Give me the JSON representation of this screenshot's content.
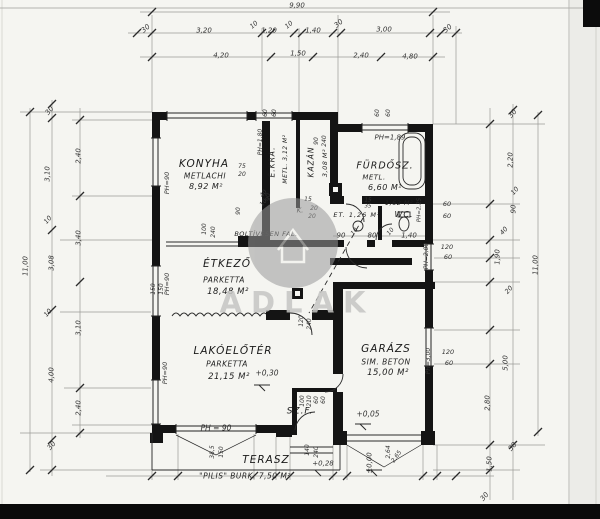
{
  "watermark": {
    "t": "ADLAK",
    "x": 297,
    "y": 303,
    "s": 29
  },
  "rooms": [
    {
      "id": "konyha",
      "label": {
        "t": "KONYHA",
        "x": 204,
        "y": 164,
        "s": 10.5
      },
      "material": {
        "t": "METLACHI",
        "x": 205,
        "y": 176,
        "s": 7.5
      },
      "area": {
        "t": "8,92 M²",
        "x": 206,
        "y": 187,
        "s": 8
      }
    },
    {
      "id": "eleskamra",
      "label": {
        "t": "É.KRA.",
        "x": 272,
        "y": 162,
        "s": 7.5,
        "r": -90
      },
      "material": {
        "t": "METL. 3,12 M²",
        "x": 286,
        "y": 159,
        "s": 6,
        "r": -90
      }
    },
    {
      "id": "kazan",
      "label": {
        "t": "KAZÁN",
        "x": 311,
        "y": 162,
        "s": 7.5,
        "r": -90
      },
      "area": {
        "t": "3,08 M²",
        "x": 325,
        "y": 163,
        "s": 6.5,
        "r": -90
      }
    },
    {
      "id": "furdoszoba",
      "label": {
        "t": "FÜRDŐSZ.",
        "x": 385,
        "y": 166,
        "s": 9.5
      },
      "material": {
        "t": "METL.",
        "x": 374,
        "y": 178,
        "s": 7
      },
      "area": {
        "t": "6,60 M²",
        "x": 385,
        "y": 188,
        "s": 8
      }
    },
    {
      "id": "eloter",
      "label": {
        "t": "ET. 1,26 M²",
        "x": 357,
        "y": 215,
        "s": 6.5
      }
    },
    {
      "id": "wc",
      "label": {
        "t": "WC.",
        "x": 404,
        "y": 215,
        "s": 8
      },
      "area": {
        "t": "1,62 M²",
        "x": 399,
        "y": 203,
        "s": 6.5
      }
    },
    {
      "id": "etkezo",
      "label": {
        "t": "ÉTKEZŐ",
        "x": 227,
        "y": 264,
        "s": 10.5
      },
      "material": {
        "t": "PARKETTA",
        "x": 224,
        "y": 280,
        "s": 7.5
      },
      "area": {
        "t": "18,48 M²",
        "x": 228,
        "y": 292,
        "s": 8.5
      }
    },
    {
      "id": "lakoeloter",
      "label": {
        "t": "LAKÓELŐTÉR",
        "x": 233,
        "y": 351,
        "s": 10.5
      },
      "material": {
        "t": "PARKETTA",
        "x": 227,
        "y": 364,
        "s": 7.5
      },
      "area": {
        "t": "21,15 M²",
        "x": 229,
        "y": 377,
        "s": 8.5
      }
    },
    {
      "id": "garazs",
      "label": {
        "t": "GARÁZS",
        "x": 386,
        "y": 349,
        "s": 10.5
      },
      "material": {
        "t": "SIM. BETON",
        "x": 386,
        "y": 362,
        "s": 7.5
      },
      "area": {
        "t": "15,00 M²",
        "x": 388,
        "y": 373,
        "s": 8.5
      }
    },
    {
      "id": "szelfogo",
      "label": {
        "t": "SZ.F.",
        "x": 300,
        "y": 412,
        "s": 9
      }
    },
    {
      "id": "terasz",
      "label": {
        "t": "TERASZ",
        "x": 266,
        "y": 460,
        "s": 10.5
      },
      "material": {
        "t": "\"PILIS\"  BURK.  7,50 M²",
        "x": 245,
        "y": 476,
        "s": 7.5
      }
    }
  ],
  "dimensions": {
    "top": [
      {
        "t": "9,90",
        "x": 297,
        "y": 6,
        "s": 7
      },
      {
        "t": "30",
        "x": 146,
        "y": 29,
        "s": 7,
        "r": -40
      },
      {
        "t": "3,20",
        "x": 204,
        "y": 31,
        "s": 7
      },
      {
        "t": "10",
        "x": 254,
        "y": 25,
        "s": 6.5,
        "r": -40
      },
      {
        "t": "1,20",
        "x": 269,
        "y": 31,
        "s": 7
      },
      {
        "t": "10",
        "x": 289,
        "y": 25,
        "s": 6.5,
        "r": -40
      },
      {
        "t": "1,40",
        "x": 313,
        "y": 31,
        "s": 7
      },
      {
        "t": "30",
        "x": 339,
        "y": 24,
        "s": 7,
        "r": -40
      },
      {
        "t": "3,00",
        "x": 384,
        "y": 30,
        "s": 7
      },
      {
        "t": "30",
        "x": 448,
        "y": 29,
        "s": 7,
        "r": -40
      },
      {
        "t": "4,20",
        "x": 221,
        "y": 56,
        "s": 7
      },
      {
        "t": "1,50",
        "x": 298,
        "y": 54,
        "s": 7
      },
      {
        "t": "2,40",
        "x": 361,
        "y": 56,
        "s": 7
      },
      {
        "t": "4,80",
        "x": 410,
        "y": 57,
        "s": 7
      }
    ],
    "left": [
      {
        "t": "30",
        "x": 50,
        "y": 111,
        "s": 7,
        "r": -50
      },
      {
        "t": "2,40",
        "x": 79,
        "y": 156,
        "s": 7,
        "r": -90
      },
      {
        "t": "3,10",
        "x": 48,
        "y": 174,
        "s": 7,
        "r": -90
      },
      {
        "t": "10",
        "x": 48,
        "y": 220,
        "s": 6.5,
        "r": -50
      },
      {
        "t": "3,40",
        "x": 79,
        "y": 238,
        "s": 7,
        "r": -90
      },
      {
        "t": "3,08",
        "x": 52,
        "y": 263,
        "s": 7,
        "r": -90
      },
      {
        "t": "11,00",
        "x": 26,
        "y": 266,
        "s": 7,
        "r": -90
      },
      {
        "t": "10",
        "x": 48,
        "y": 313,
        "s": 6.5,
        "r": -50
      },
      {
        "t": "3,10",
        "x": 79,
        "y": 328,
        "s": 7,
        "r": -90
      },
      {
        "t": "4,00",
        "x": 52,
        "y": 375,
        "s": 7,
        "r": -90
      },
      {
        "t": "2,40",
        "x": 79,
        "y": 408,
        "s": 7,
        "r": -90
      },
      {
        "t": "30",
        "x": 52,
        "y": 446,
        "s": 7,
        "r": -50
      }
    ],
    "right": [
      {
        "t": "30",
        "x": 513,
        "y": 114,
        "s": 7,
        "r": -50
      },
      {
        "t": "2,20",
        "x": 511,
        "y": 160,
        "s": 7,
        "r": -90
      },
      {
        "t": "10",
        "x": 515,
        "y": 191,
        "s": 6.5,
        "r": -50
      },
      {
        "t": "90",
        "x": 514,
        "y": 209,
        "s": 7,
        "r": -90
      },
      {
        "t": "40",
        "x": 504,
        "y": 231,
        "s": 6.5,
        "r": -50
      },
      {
        "t": "1,90",
        "x": 498,
        "y": 257,
        "s": 7,
        "r": -90
      },
      {
        "t": "20",
        "x": 509,
        "y": 290,
        "s": 6.5,
        "r": -50
      },
      {
        "t": "11,00",
        "x": 536,
        "y": 265,
        "s": 7,
        "r": -90
      },
      {
        "t": "5,00",
        "x": 506,
        "y": 363,
        "s": 7,
        "r": -90
      },
      {
        "t": "2,80",
        "x": 488,
        "y": 403,
        "s": 7,
        "r": -90
      },
      {
        "t": "30",
        "x": 513,
        "y": 447,
        "s": 7,
        "r": -50
      },
      {
        "t": "1,50",
        "x": 490,
        "y": 464,
        "s": 7,
        "r": -90
      },
      {
        "t": "30",
        "x": 485,
        "y": 497,
        "s": 7,
        "r": -50
      }
    ],
    "bottom": [
      {
        "t": "38,5",
        "x": 213,
        "y": 452,
        "s": 6,
        "r": -90
      },
      {
        "t": "150",
        "x": 222,
        "y": 452,
        "s": 6,
        "r": -90
      },
      {
        "t": "140",
        "x": 308,
        "y": 450,
        "s": 6,
        "r": -90
      },
      {
        "t": "240",
        "x": 317,
        "y": 452,
        "s": 6,
        "r": -90
      },
      {
        "t": "2,64",
        "x": 389,
        "y": 452,
        "s": 6,
        "r": -90
      },
      {
        "t": "2,65",
        "x": 397,
        "y": 457,
        "s": 6,
        "r": -55
      }
    ],
    "openings": [
      {
        "t": "60",
        "x": 266,
        "y": 113,
        "s": 6,
        "r": -90
      },
      {
        "t": "60",
        "x": 275,
        "y": 113,
        "s": 6,
        "r": -90
      },
      {
        "t": "60",
        "x": 378,
        "y": 113,
        "s": 6,
        "r": -90
      },
      {
        "t": "60",
        "x": 389,
        "y": 113,
        "s": 6,
        "r": -90
      },
      {
        "t": "75",
        "x": 242,
        "y": 167,
        "s": 6
      },
      {
        "t": "20",
        "x": 242,
        "y": 175,
        "s": 6
      },
      {
        "t": "40",
        "x": 264,
        "y": 194,
        "s": 6,
        "r": -50
      },
      {
        "t": "10",
        "x": 264,
        "y": 203,
        "s": 6,
        "r": -50
      },
      {
        "t": "90",
        "x": 239,
        "y": 211,
        "s": 6,
        "r": -90
      },
      {
        "t": "100",
        "x": 205,
        "y": 229,
        "s": 6,
        "r": -90
      },
      {
        "t": "240",
        "x": 214,
        "y": 232,
        "s": 6,
        "r": -90
      },
      {
        "t": "90",
        "x": 269,
        "y": 197,
        "s": 6,
        "r": -90
      },
      {
        "t": "90",
        "x": 317,
        "y": 141,
        "s": 6,
        "r": -90
      },
      {
        "t": "240",
        "x": 325,
        "y": 141,
        "s": 6,
        "r": -90
      },
      {
        "t": "15",
        "x": 308,
        "y": 200,
        "s": 6
      },
      {
        "t": "K.",
        "x": 300,
        "y": 211,
        "s": 7
      },
      {
        "t": "20",
        "x": 314,
        "y": 209,
        "s": 6
      },
      {
        "t": "20",
        "x": 312,
        "y": 217,
        "s": 6
      },
      {
        "t": "15",
        "x": 368,
        "y": 201,
        "s": 5.5
      },
      {
        "t": "35",
        "x": 368,
        "y": 207,
        "s": 5.5
      },
      {
        "t": "90",
        "x": 341,
        "y": 236,
        "s": 7
      },
      {
        "t": "10",
        "x": 355,
        "y": 232,
        "s": 6,
        "r": -50
      },
      {
        "t": "80",
        "x": 372,
        "y": 236,
        "s": 7
      },
      {
        "t": "10",
        "x": 391,
        "y": 232,
        "s": 6,
        "r": -50
      },
      {
        "t": "1,40",
        "x": 409,
        "y": 236,
        "s": 7
      },
      {
        "t": "60",
        "x": 447,
        "y": 204,
        "s": 6.5
      },
      {
        "t": "60",
        "x": 447,
        "y": 216,
        "s": 6.5
      },
      {
        "t": "120",
        "x": 447,
        "y": 247,
        "s": 6.5
      },
      {
        "t": "60",
        "x": 448,
        "y": 257,
        "s": 6.5
      },
      {
        "t": "120",
        "x": 448,
        "y": 352,
        "s": 6.5
      },
      {
        "t": "60",
        "x": 449,
        "y": 363,
        "s": 6.5
      },
      {
        "t": "100",
        "x": 303,
        "y": 401,
        "s": 6,
        "r": -90
      },
      {
        "t": "210",
        "x": 310,
        "y": 401,
        "s": 6,
        "r": -90
      },
      {
        "t": "60",
        "x": 317,
        "y": 400,
        "s": 6,
        "r": -90
      },
      {
        "t": "60",
        "x": 324,
        "y": 400,
        "s": 6,
        "r": -90
      },
      {
        "t": "120",
        "x": 302,
        "y": 321,
        "s": 6,
        "r": -90
      },
      {
        "t": "240",
        "x": 310,
        "y": 324,
        "s": 6,
        "r": -90
      },
      {
        "t": "150",
        "x": 154,
        "y": 289,
        "s": 6,
        "r": -90
      },
      {
        "t": "150",
        "x": 162,
        "y": 289,
        "s": 6,
        "r": -90
      }
    ]
  },
  "parapet_heights": [
    {
      "t": "PH=90",
      "x": 167,
      "y": 183,
      "s": 6.5,
      "r": -90
    },
    {
      "t": "PH=1,80",
      "x": 261,
      "y": 142,
      "s": 6,
      "r": -90
    },
    {
      "t": "PH=1,89",
      "x": 390,
      "y": 138,
      "s": 7
    },
    {
      "t": "PH=2,25",
      "x": 420,
      "y": 210,
      "s": 5.5,
      "r": -90
    },
    {
      "t": "PH=2,00",
      "x": 427,
      "y": 256,
      "s": 6,
      "r": -90
    },
    {
      "t": "PH=90",
      "x": 167,
      "y": 284,
      "s": 6.5,
      "r": -90
    },
    {
      "t": "PH=90",
      "x": 165,
      "y": 373,
      "s": 6.5,
      "r": -90
    },
    {
      "t": "PH=3,00",
      "x": 429,
      "y": 361,
      "s": 6,
      "r": -90
    },
    {
      "t": "PH = 90",
      "x": 216,
      "y": 428,
      "s": 7.5
    }
  ],
  "level_marks": [
    {
      "t": "+0,30",
      "x": 267,
      "y": 373,
      "s": 7.5
    },
    {
      "t": "+0,05",
      "x": 368,
      "y": 414,
      "s": 7.5
    },
    {
      "t": "+0,28",
      "x": 323,
      "y": 464,
      "s": 7
    },
    {
      "t": "±0,00",
      "x": 370,
      "y": 463,
      "s": 7,
      "r": -90
    }
  ],
  "notes": [
    {
      "t": "BOLTÍVESEN  FAL.",
      "x": 266,
      "y": 234,
      "s": 6.5
    }
  ]
}
